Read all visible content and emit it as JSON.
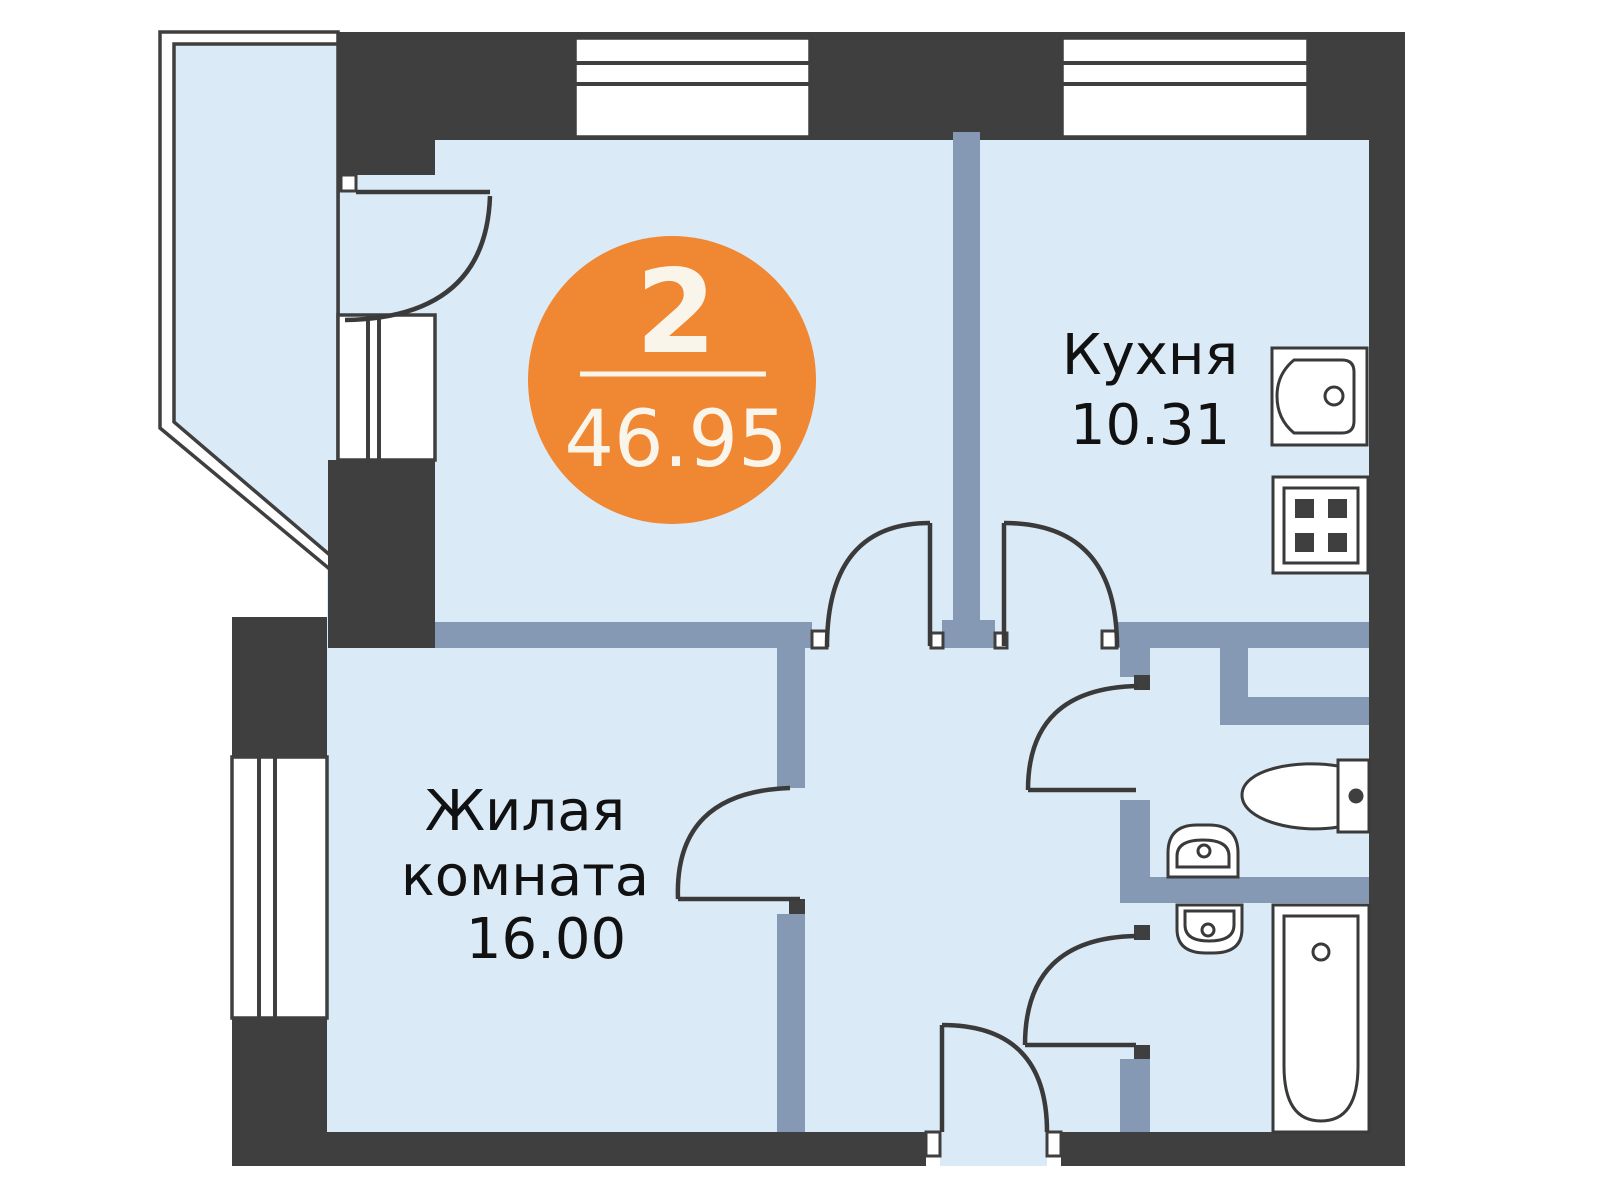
{
  "plan": {
    "badge": {
      "rooms_count": "2",
      "total_area": "46.95"
    },
    "rooms": [
      {
        "id": "kitchen",
        "label": "Кухня",
        "area": "10.31"
      },
      {
        "id": "living-room",
        "label_line1": "Жилая",
        "label_line2": "комната",
        "area": "16.00"
      }
    ],
    "fixtures": [
      "kitchen-sink-icon",
      "stove-icon",
      "toilet-icon",
      "washbasin-icon",
      "washbasin-icon",
      "bathtub-icon"
    ],
    "unlabeled_spaces": [
      "balcony",
      "hallway",
      "wc",
      "bathroom",
      "second-room"
    ]
  },
  "colors": {
    "accent": "#EF8733",
    "badge_text": "#FAF5EA",
    "wall_dark": "#3F3F3F",
    "wall_partition": "#8598B4",
    "room_fill": "#DBEAF7",
    "door_line": "#3A3A3A",
    "label_text": "#111111"
  }
}
